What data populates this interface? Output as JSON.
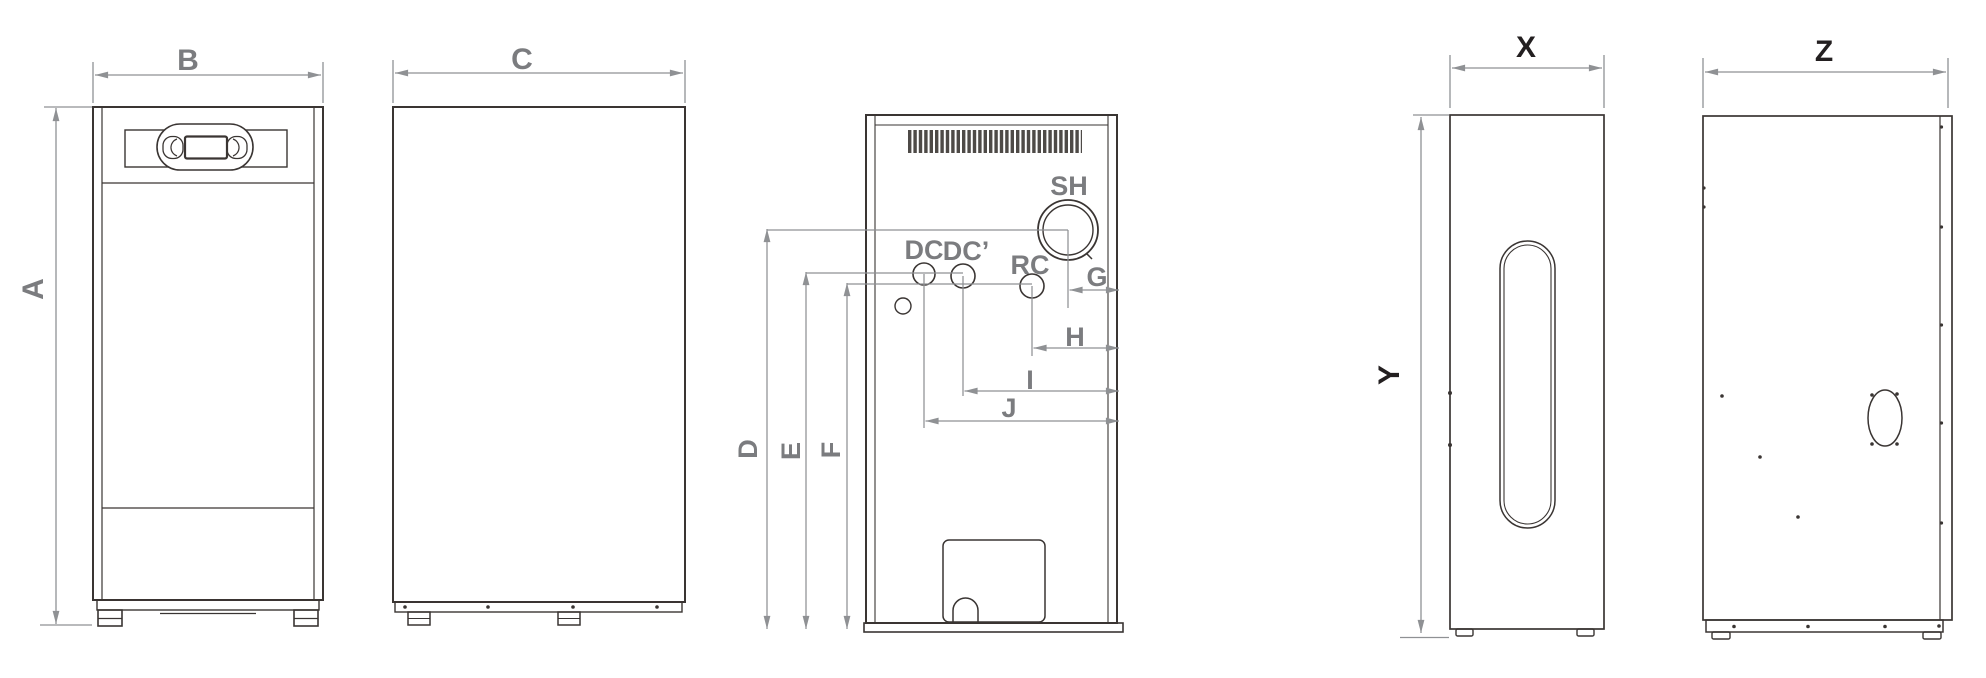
{
  "colors": {
    "background": "#ffffff",
    "outline": "#3a3533",
    "dimension": "#8f9194",
    "label_gray": "#7b7c7f",
    "label_dark": "#231f20"
  },
  "labels": {
    "a": "A",
    "b": "B",
    "c": "C",
    "d": "D",
    "e": "E",
    "f": "F",
    "g": "G",
    "h": "H",
    "i": "I",
    "j": "J",
    "sh": "SH",
    "dc": "DC",
    "dc_prime": "DC’",
    "rc": "RC",
    "x": "X",
    "y": "Y",
    "z": "Z"
  }
}
